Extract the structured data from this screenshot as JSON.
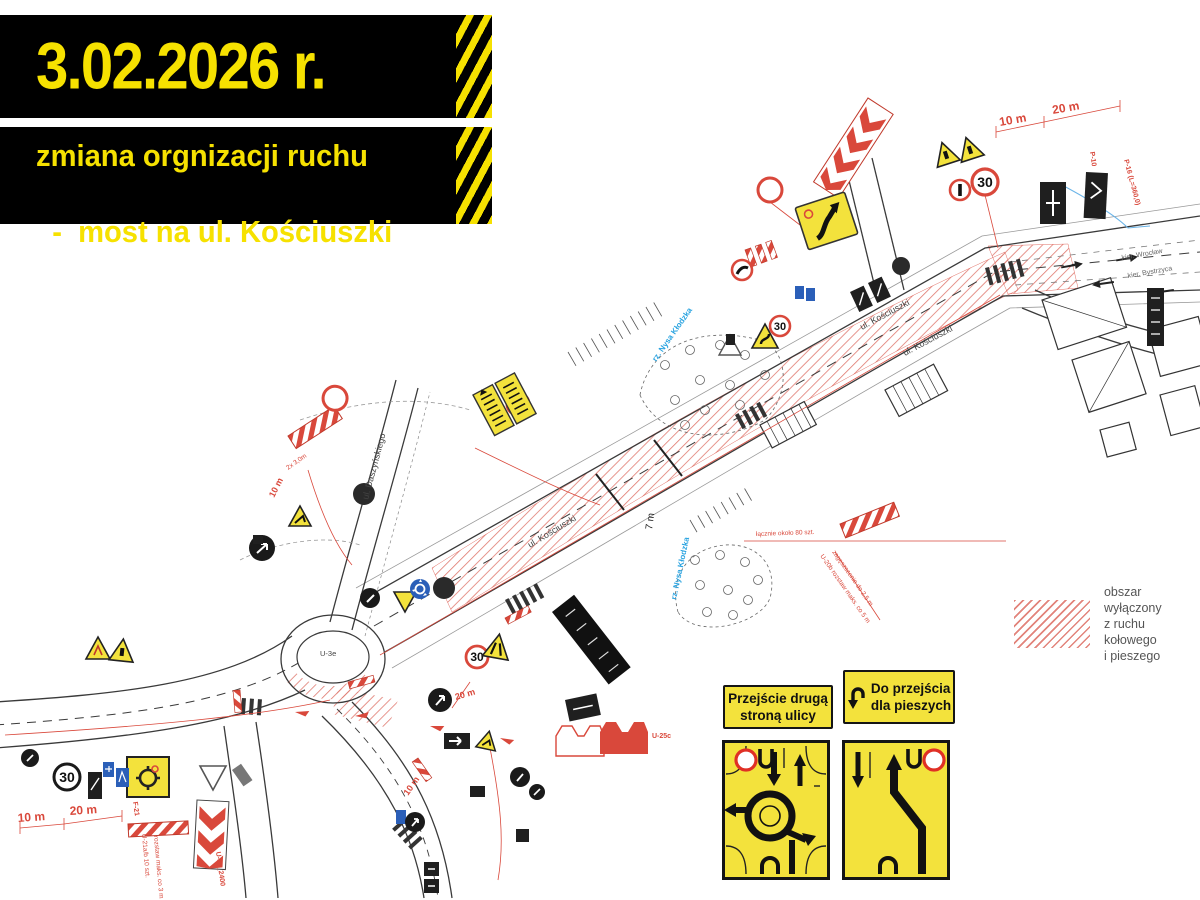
{
  "banner": {
    "date": "3.02.2026 r.",
    "line1": "zmiana orgnizacji ruchu",
    "line2": "-  most na ul. Kościuszki"
  },
  "legend": {
    "line1": "obszar wyłączony",
    "line2": "z ruchu kołowego",
    "line3": "i pieszego"
  },
  "boards": {
    "left_line1": "Przejście drugą",
    "left_line2": "stroną ulicy",
    "right_line1": "Do przejścia",
    "right_line2": "dla pieszych"
  },
  "map": {
    "streets": {
      "kosciuszki_a": "ul. Kościuszki",
      "kosciuszki_b": "ul. Kościuszki",
      "kosciuszki_c": "ul. Kościuszki",
      "daszynskiego": "ul. Daszyńskiego"
    },
    "river": {
      "a": "rz. Nysa Kłodzka",
      "b": "rz. Nysa Kłodzka"
    },
    "directions": {
      "kier1": "kier. Wrocław",
      "kier2": "kier. Bystrzyca"
    },
    "dimensions": {
      "d10_tr": "10 m",
      "d20_tr": "20 m",
      "d7": "7 m",
      "d20_rondo": "20 m",
      "d10_mid": "10 m",
      "d10_left": "10 m",
      "d10_bl": "10 m",
      "d20_bl": "20 m",
      "d2x3": "2x 3,0m"
    },
    "speed30": "30",
    "island_label": "U-3e",
    "sign_codes": {
      "p16": "P-16 (L=360,0)",
      "p10": "P-10",
      "f21": "F-21",
      "u25c": "U-25c",
      "u3e2400": "U-3e_2400"
    },
    "annotations": {
      "szt80": "łącznie około 80 szt.",
      "u20b_1": "U-20b  rozstaw maks. co 5 m",
      "u20b_2": "zagęszczenie do 2,5 m",
      "u21_1": "U-21a/b  10 szt.",
      "u21_2": "rozstaw maks. co 3 m"
    }
  },
  "colors": {
    "banner_yellow": "#f6e100",
    "map_red": "#d9483b",
    "river_blue": "#29a3e0",
    "sign_yellow": "#f3e23c",
    "sign_blue": "#2b5fb8",
    "legend_gray": "#555555"
  }
}
